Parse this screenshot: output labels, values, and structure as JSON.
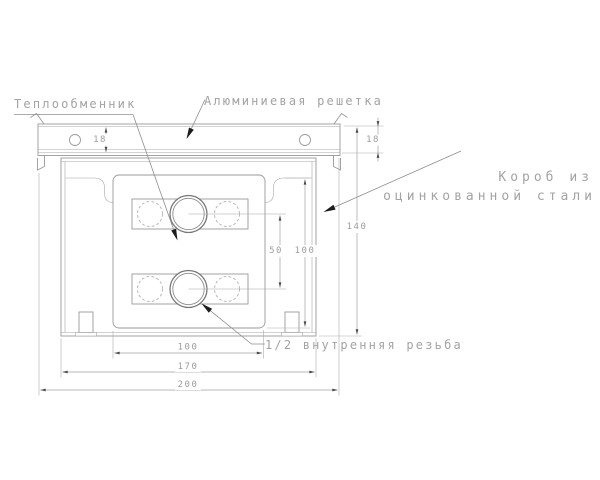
{
  "drawing": {
    "labels": {
      "heat_exchanger": "Теплообменник",
      "aluminum_grille": "Алюминиевая решетка",
      "box_line1": "Короб из",
      "box_line2": "оцинкованной стали",
      "thread": "1/2 внутренняя резьба"
    },
    "dimensions": {
      "grille_height_left": "18",
      "grille_height_right": "18",
      "overall_height": "140",
      "core_height": "100",
      "pipe_spacing": "50",
      "core_width": "100",
      "box_width": "170",
      "overall_width": "200"
    },
    "colors": {
      "line": "#9a9a9a",
      "text": "#a3a3a3",
      "arrowhead": "#1c1c1c",
      "background": "#ffffff"
    }
  }
}
